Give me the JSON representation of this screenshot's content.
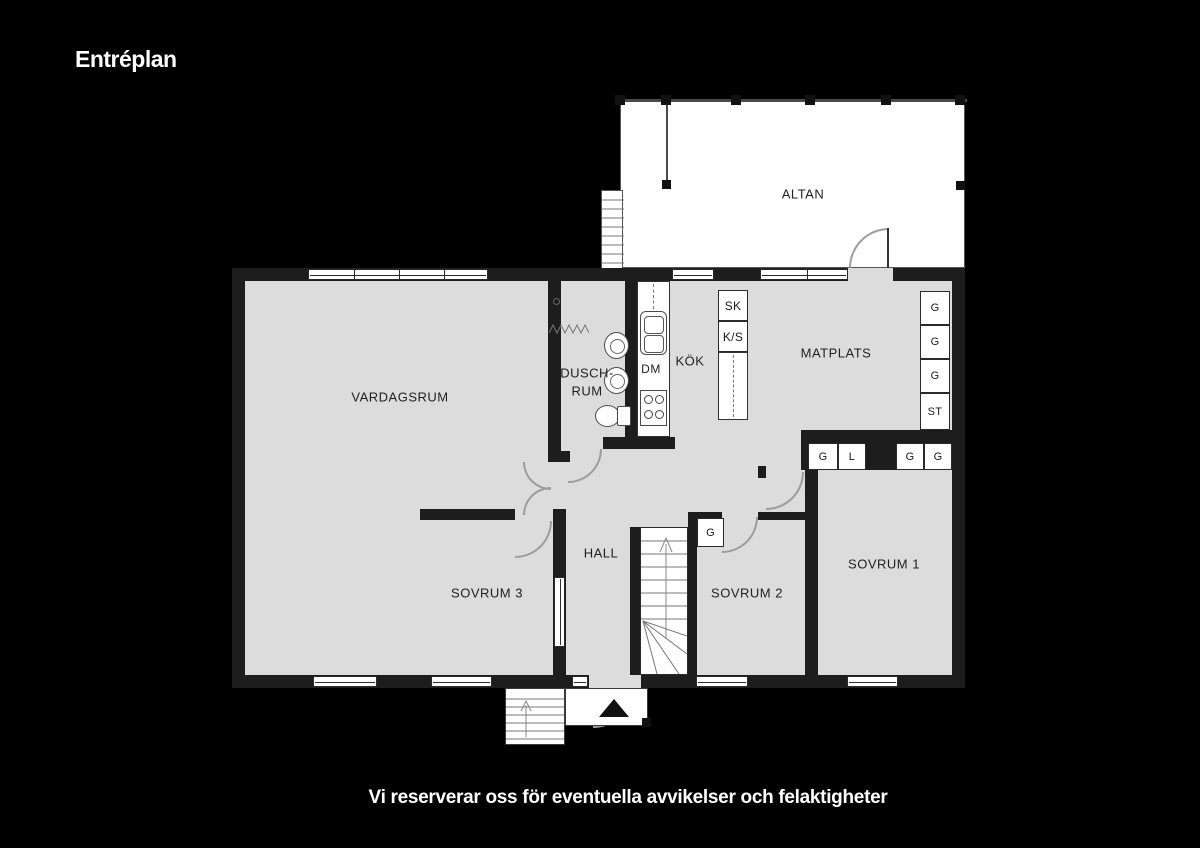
{
  "title": "Entréplan",
  "disclaimer": "Vi reserverar oss för eventuella avvikelser och felaktigheter",
  "colors": {
    "background": "#000000",
    "floor": "#dcdcdc",
    "wall": "#1d1d1d",
    "outdoor_white": "#ffffff",
    "thin_line": "#777777",
    "door_arc": "#9c9c9c",
    "text": "#1f1f1f",
    "title_text": "#ffffff"
  },
  "rooms": {
    "altan": "ALTAN",
    "vardagsrum": "VARDAGSRUM",
    "duschrum_line1": "DUSCH-",
    "duschrum_line2": "RUM",
    "kok": "KÖK",
    "matplats": "MATPLATS",
    "hall": "HALL",
    "sovrum1": "SOVRUM 1",
    "sovrum2": "SOVRUM 2",
    "sovrum3": "SOVRUM 3"
  },
  "kitchen": {
    "dm": "DM",
    "sk": "SK",
    "ks": "K/S"
  },
  "closets": {
    "right_column": [
      "G",
      "G",
      "G",
      "ST"
    ],
    "matplats_row": [
      "G",
      "L",
      "G",
      "G"
    ],
    "sovrum2": "G"
  }
}
